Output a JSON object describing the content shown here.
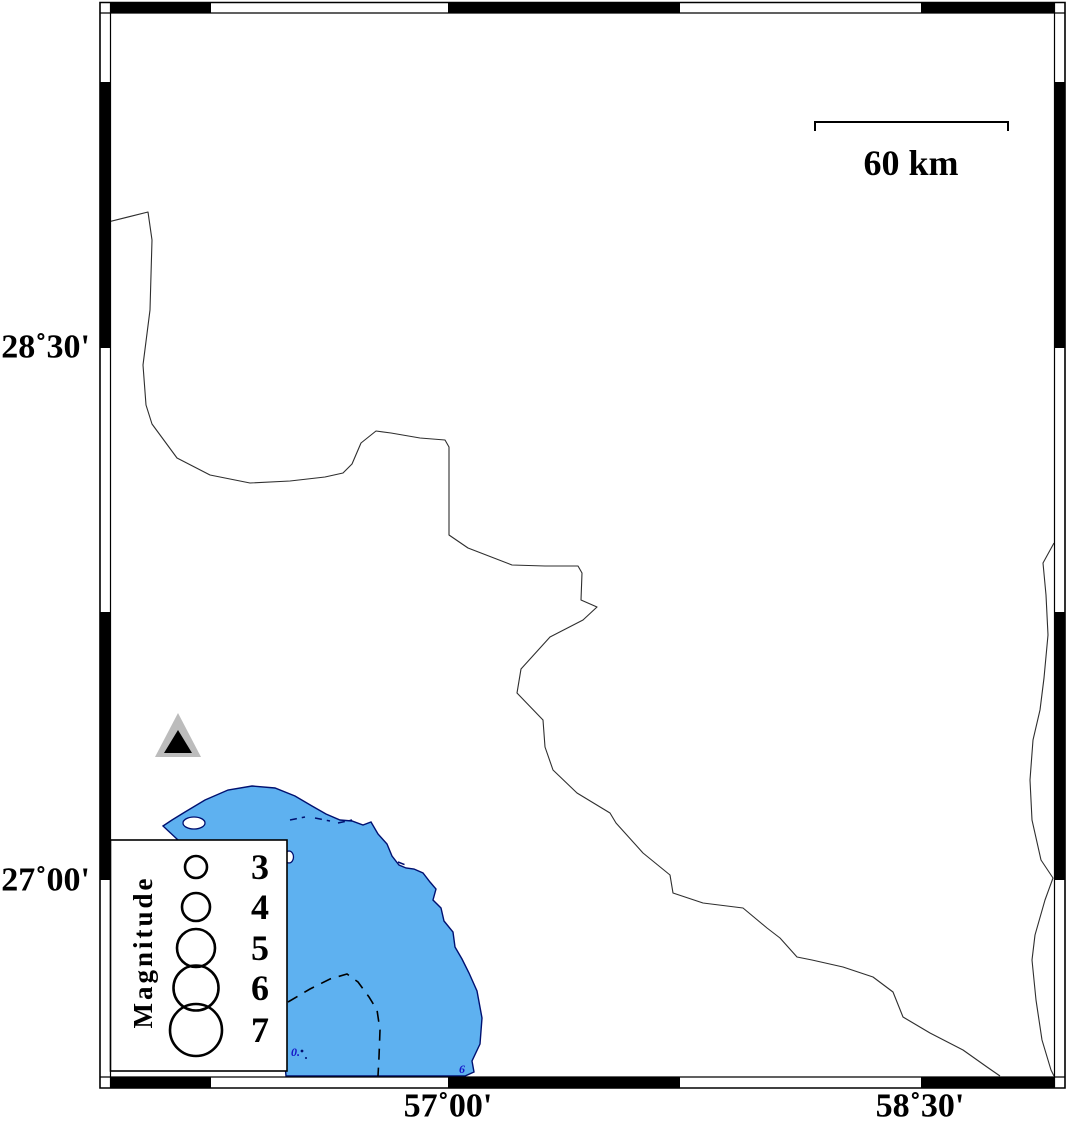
{
  "map": {
    "description": "seismicity-station-map",
    "axis": {
      "lat_labels": [
        {
          "text": "28˚30'"
        },
        {
          "text": "27˚00'"
        }
      ],
      "lon_labels": [
        {
          "text": "57˚00'"
        },
        {
          "text": "58˚30'"
        }
      ]
    },
    "scale_bar": {
      "label": "60 km"
    },
    "legend": {
      "title": "Magnitude",
      "items": [
        {
          "label": "3",
          "r": 11
        },
        {
          "label": "4",
          "r": 14
        },
        {
          "label": "5",
          "r": 19
        },
        {
          "label": "6",
          "r": 22.5
        },
        {
          "label": "7",
          "r": 26
        }
      ]
    },
    "station": {
      "symbol": "triangle"
    },
    "bathy_labels": [
      {
        "text": "6"
      },
      {
        "text": "0."
      }
    ],
    "colors": {
      "water": "#5EB1F0",
      "coast": "#001070",
      "frame": "#000000",
      "land": "#ffffff",
      "boundary_line": "#2e2e2e",
      "triangle_gray": "#bcbcbc",
      "triangle_black": "#000000"
    },
    "geometry": {
      "coast_water": "M163,826 L172,820 L185,812 L205,800 L228,790 L252,786 L275,788 L295,796 L312,806 L326,814 L340,820 L352,821 L363,825 L371,822 L378,834 L387,844 L392,856 L399,865 L406,868 L414,869 L423,873 L430,882 L436,889 L433,900 L441,908 L444,921 L453,932 L455,947 L462,959 L469,973 L477,991 L482,1018 L480,1044 L472,1061 L474,1072 L465,1076 L286,1076 L282,1030 L265,975 L238,920 L205,868 L178,840 Z",
      "boundary_line": "M100,224 L148,212 L152,240 L150,310 L143,365 L146,405 L152,424 L177,458 L210,475 L250,483 L290,481 L325,477 L343,473 L352,464 L361,443 L376,431 L391,433 L420,438 L445,440 L449,447 L449,535 L468,548 L512,565 L545,566 L578,566 L582,573 L581,600 L597,607 L583,620 L550,637 L521,669 L517,693 L543,720 L545,747 L553,770 L577,793 L610,813 L616,823 L643,853 L670,875 L673,893 L703,903 L743,908 L767,928 L780,938 L797,957 L812,960 L843,967 L873,977 L893,992 L903,1017 L930,1033 L963,1050 L987,1067 L1000,1076",
      "right_line": "M1054,543 L1043,563 L1046,595 L1048,635 L1044,678 L1040,710 L1033,740 L1030,780 L1032,820 L1041,860 L1053,878 L1045,900 L1035,935 L1032,960 L1036,1000 L1042,1040 L1051,1070 L1054,1076",
      "bathy_dashed": "M288,1002 L310,989 L330,979 L347,974 L358,982 L369,997 L377,1010 L380,1030 L379,1057 L378,1076",
      "tidal_dashes": "M290,820 L305,817 M315,818 L330,821 M338,823 L352,820 M398,862 L408,866",
      "frame_outer": "M100,2.5 L1065,2.5 L1065,1088 L100,1088 Z",
      "frame_inner": "M110.5,13 L1054.5,13 L1054.5,1077 L110.5,1077 Z",
      "frame_top_black": "M110,2.5 H211 V13 H110 Z M448,2.5 H680 V13 H448 Z M921,2.5 H1054.5 V13 H921 Z",
      "frame_bottom_black": "M110,1077 H211 V1088 H110 Z M448,1077 H680 V1088 H448 Z M921,1077 H1054.5 V1088 H921 Z",
      "frame_left_black": "M100,82 H110.5 V348 H100 Z M100,612 H110.5 V880 H100 Z",
      "frame_right_black": "M1054.5,82 H1065 V348 H1054.5 Z M1054.5,612 H1065 V880 H1054.5 Z",
      "frame_corner_lines": "M110.5,2.5 L110.5,13 M1054.5,2.5 L1054.5,13 M110.5,1077 L110.5,1088 M1054.5,1077 L1054.5,1088 M100,13 L110.5,13 M1054.5,13 L1065,13 M100,1077 L110.5,1077 M1054.5,1077 L1065,1077",
      "scale_bracket": "M815,131 L815,122 L1008,122 L1008,131",
      "triangle_gray_points": "178,713 155,757 201,757",
      "triangle_black_points": "178,730 164,753 192,753"
    }
  }
}
